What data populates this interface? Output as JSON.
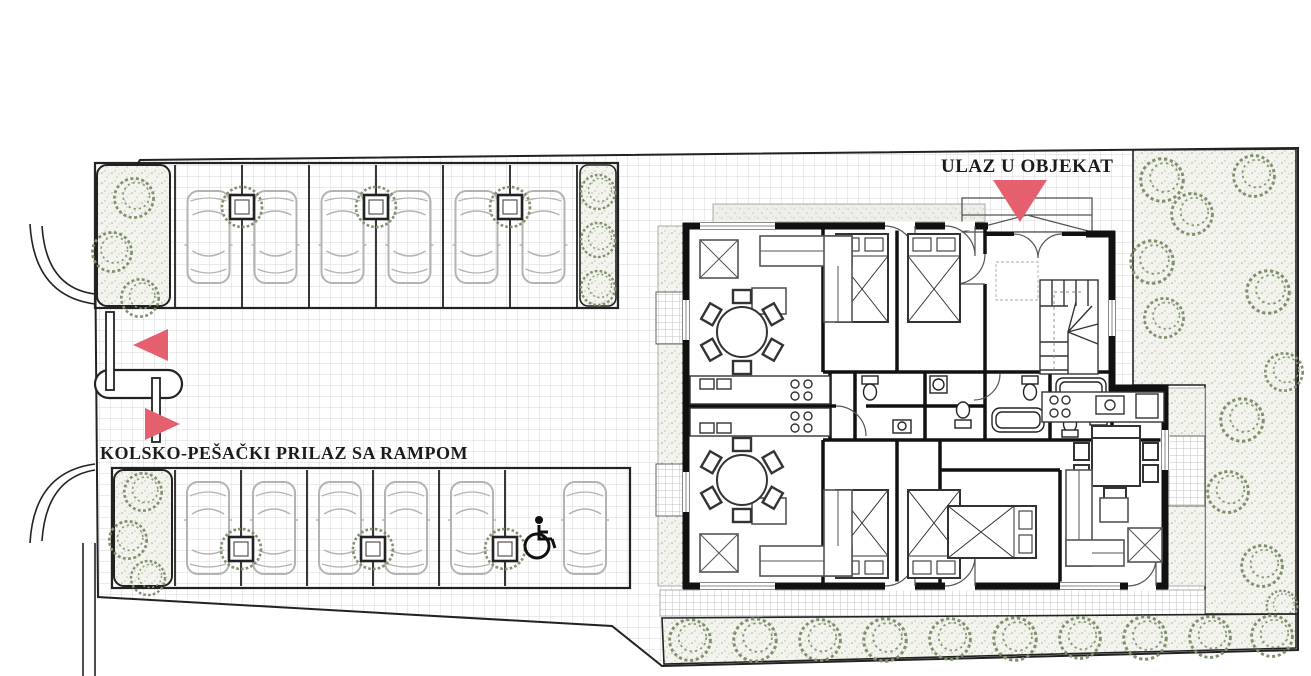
{
  "labels": {
    "entrance": "ULAZ U OBJEKAT",
    "access": "KOLSKO-PEŠAČKI PRILAZ SA RAMPOM"
  },
  "colors": {
    "accent_red": "#e5606e",
    "tree_green": "#7f926d",
    "line_black": "#1b1b1b",
    "car_gray": "#b3b3b3",
    "paving_line": "#d7d7d7",
    "planting_bg": "#f4f4ef"
  },
  "parking": {
    "top_row": {
      "spaces": 6,
      "divider_planters": 3,
      "left_planting_trees": 3,
      "right_planting_trees": 3
    },
    "bottom_row": {
      "standard_spaces": 5,
      "accessible_spaces": 1,
      "divider_planters": 3,
      "left_planting_trees": 3
    },
    "cars_drawn": 12
  },
  "ramp": {
    "barriers": 2,
    "arrow_directions": [
      "left",
      "right"
    ]
  },
  "entrance_marker": {
    "shape": "triangle-down",
    "color": "#e5606e"
  },
  "building": {
    "stair_flight": true,
    "unit_layouts_drawn": 4,
    "beds_drawn": 5,
    "round_dining_tables": 2,
    "square_dining_tables": 1
  },
  "landscape": {
    "right_green_trees": 11,
    "bottom_strip_trees": 10
  }
}
